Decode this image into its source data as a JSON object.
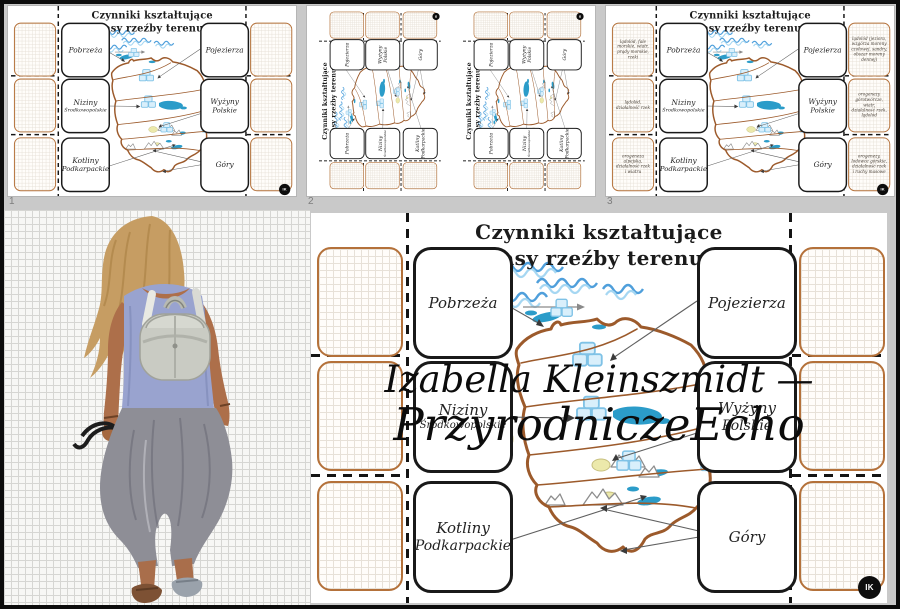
{
  "app": {
    "badge": "IK",
    "thumbnail_numbers": [
      "1",
      "2",
      "3"
    ]
  },
  "worksheet": {
    "title_line1": "Czynniki kształtujące",
    "title_line2": "pasy rzeźby terenu.",
    "left_boxes": [
      {
        "label1": "Pobrzeża",
        "label2": ""
      },
      {
        "label1": "Niziny",
        "label2": "Środkowopolskie"
      },
      {
        "label1": "Kotliny",
        "label2": "Podkarpackie"
      }
    ],
    "right_boxes": [
      {
        "label1": "Pojezierza",
        "label2": ""
      },
      {
        "label1": "Wyżyny",
        "label2": "Polskie"
      },
      {
        "label1": "Góry",
        "label2": ""
      }
    ],
    "answers_left": [
      "lądolód, fale morskie, wiatr, prądy morskie, rzeki",
      "lądolód, działalność rzek",
      "orogeneza alpejska, działalność rzek i wiatru"
    ],
    "answers_right": [
      "lądolód (jeziora, wzgórza moreny czołowej, sandry, obszar moreny dennej)",
      "orogenezy górotwórcze, wiatr, działalność rzek, lądolód",
      "orogenezy, lodowce górskie, działalność rzek i ruchy masowe"
    ]
  },
  "watermark": {
    "line1": "Izabella Kleinszmidt —",
    "line2": "PrzyrodniczeEcho"
  },
  "colors": {
    "cut_box_brown": "#b4713a",
    "label_box_black": "#191919",
    "map_outline_brown": "#9c5a2b",
    "wave_blue": "#4f9fdb",
    "lake_blue": "#2b9cc9",
    "ice_blue": "#d9effb",
    "chrome_gray": "#c9c9c9"
  }
}
